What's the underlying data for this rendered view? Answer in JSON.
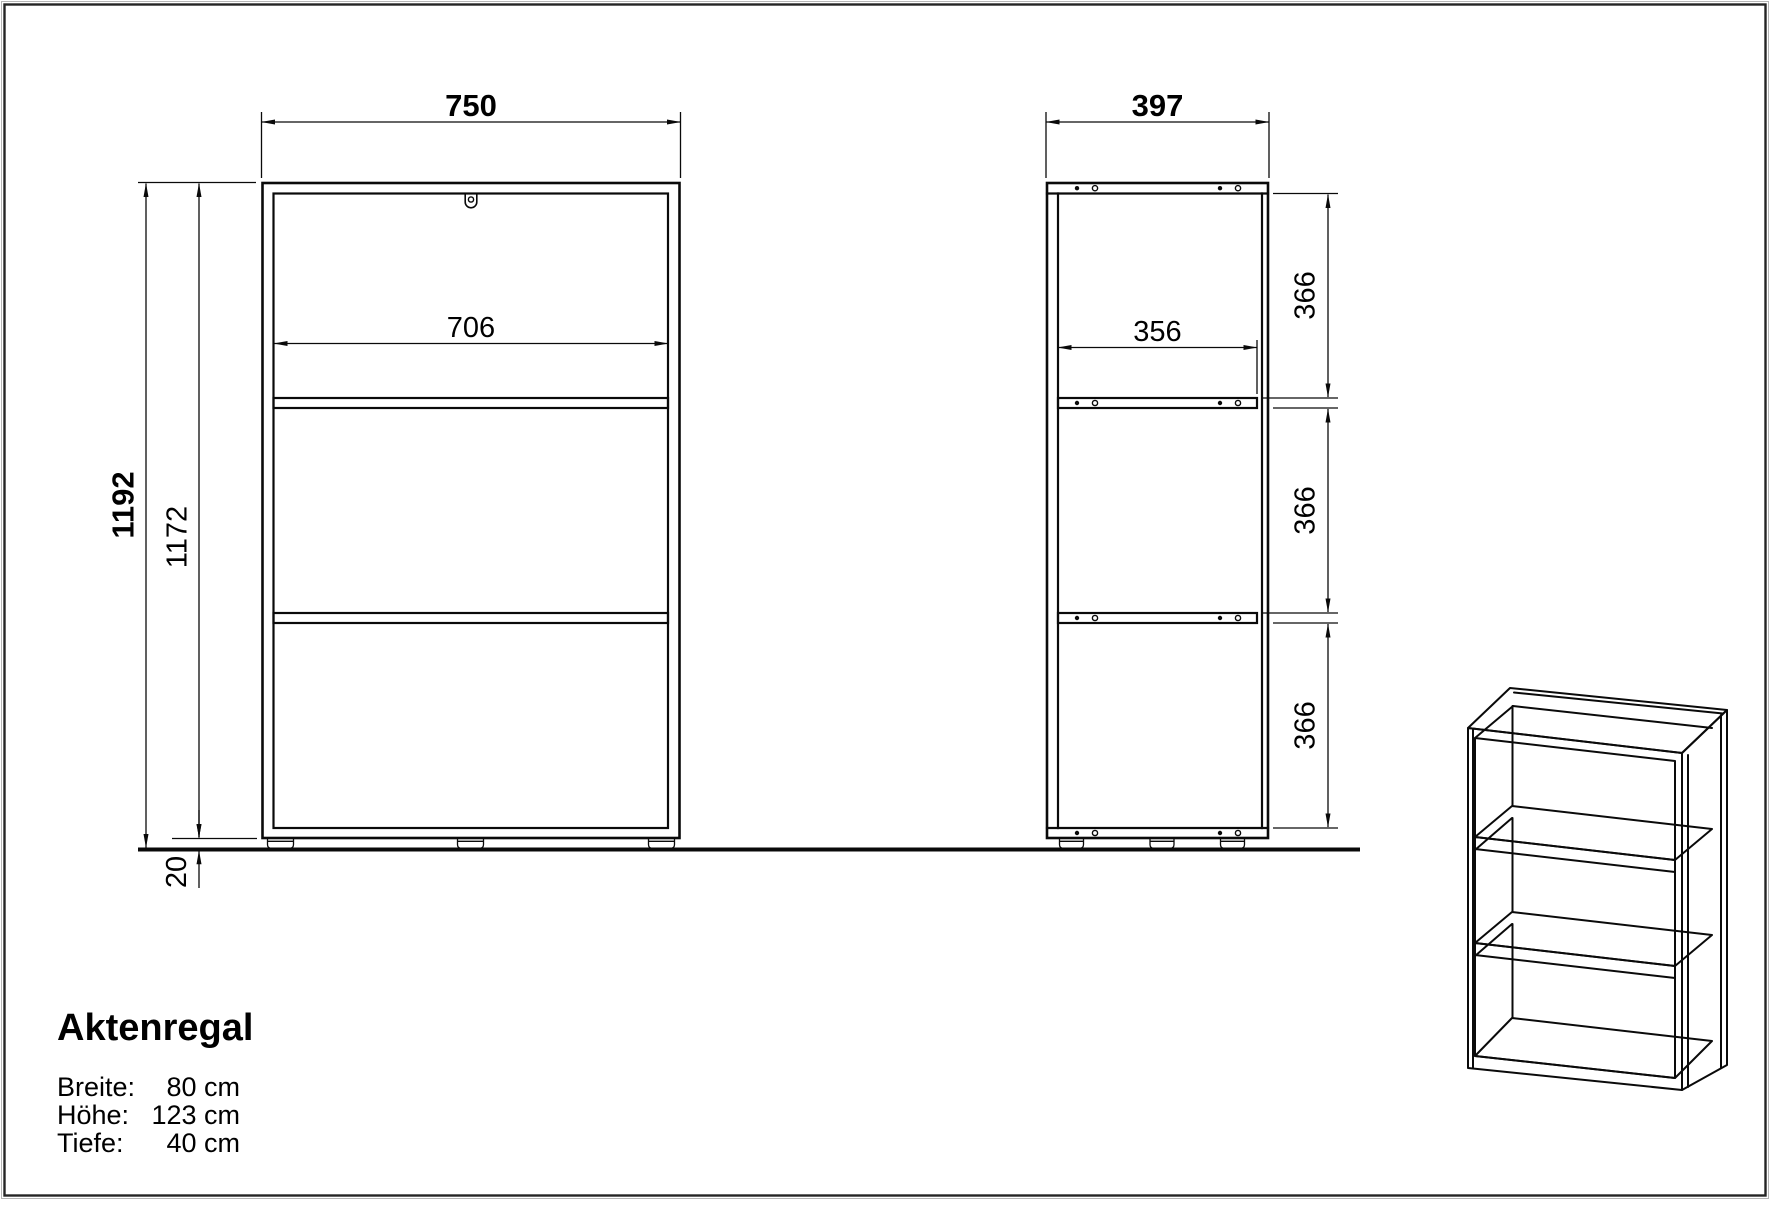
{
  "drawing": {
    "product_title": "Aktenregal",
    "specs": [
      {
        "label": "Breite:",
        "value": "80 cm"
      },
      {
        "label": "Höhe:",
        "value": "123 cm"
      },
      {
        "label": "Tiefe:",
        "value": "40 cm"
      }
    ],
    "front_view": {
      "overall_width_mm": "750",
      "inner_width_mm": "706",
      "overall_height_mm": "1192",
      "body_height_mm": "1172",
      "foot_height_mm": "20"
    },
    "side_view": {
      "overall_depth_mm": "397",
      "inner_depth_mm": "356",
      "section_heights_mm": [
        "366",
        "366",
        "366"
      ]
    },
    "colors": {
      "line": "#0a0a0a",
      "background": "#ffffff"
    }
  }
}
